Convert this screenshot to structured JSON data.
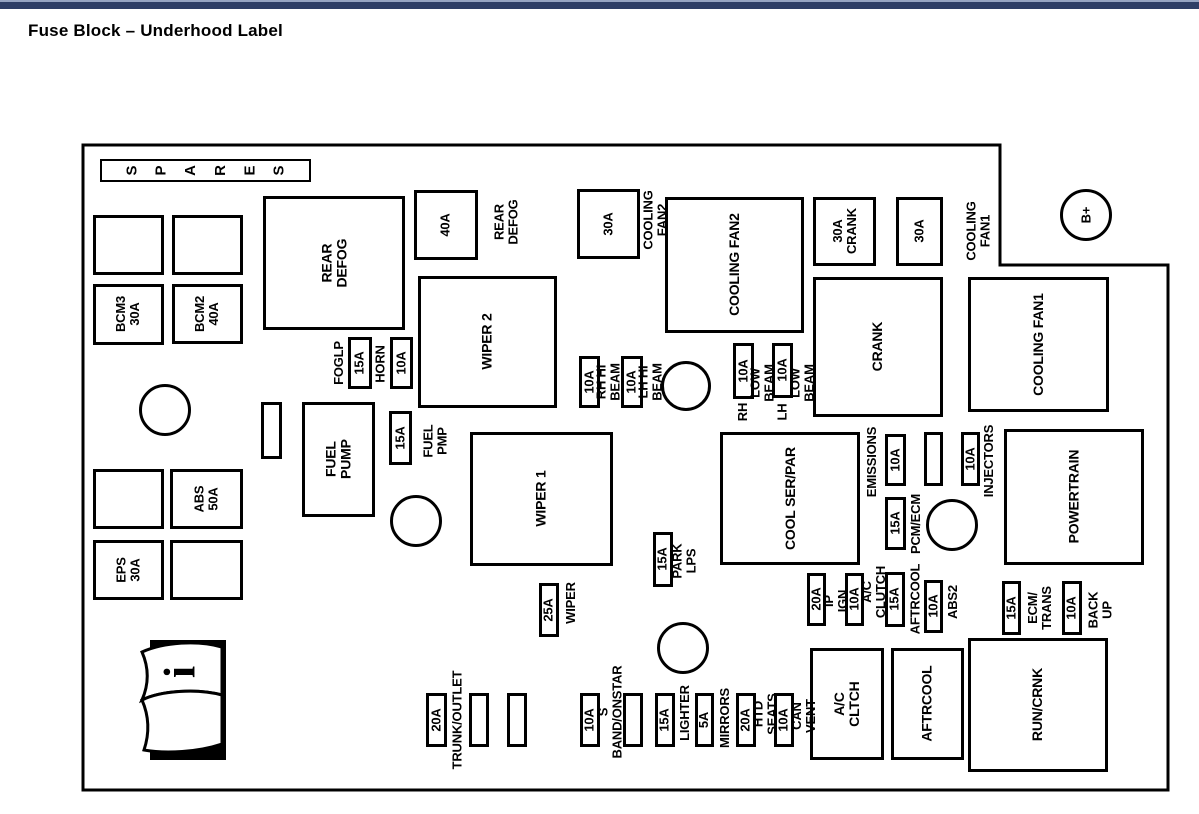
{
  "header": {
    "title": "Fuse Block – Underhood Label"
  },
  "colors": {
    "top_bar_dark": "#2e3e66",
    "top_bar_light": "#96a4c2",
    "line": "#000000",
    "background": "#ffffff"
  },
  "diagram": {
    "outline_points": "83,145 1000,145 1000,265 1168,265 1168,790 83,790",
    "spares": {
      "label": "SPARES",
      "x": 100,
      "y": 159,
      "w": 211,
      "h": 23
    },
    "info_icon": {
      "glyph": "i",
      "x": 136,
      "y": 638,
      "w": 92,
      "h": 124
    },
    "relays": [
      {
        "id": "rear-defog",
        "label": "REAR\nDEFOG",
        "x": 263,
        "y": 196,
        "w": 142,
        "h": 134
      },
      {
        "id": "wiper-2",
        "label": "WIPER 2",
        "x": 418,
        "y": 276,
        "w": 139,
        "h": 132
      },
      {
        "id": "fuel-pump",
        "label": "FUEL\nPUMP",
        "x": 302,
        "y": 402,
        "w": 73,
        "h": 115
      },
      {
        "id": "cooling-fan2",
        "label": "COOLING FAN2",
        "x": 665,
        "y": 197,
        "w": 139,
        "h": 136
      },
      {
        "id": "crank",
        "label": "CRANK",
        "x": 813,
        "y": 277,
        "w": 130,
        "h": 140
      },
      {
        "id": "cooling-fan1",
        "label": "COOLING FAN1",
        "x": 968,
        "y": 277,
        "w": 141,
        "h": 135
      },
      {
        "id": "wiper-1",
        "label": "WIPER 1",
        "x": 470,
        "y": 432,
        "w": 143,
        "h": 134
      },
      {
        "id": "cool-ser-par",
        "label": "COOL SER/PAR",
        "x": 720,
        "y": 432,
        "w": 140,
        "h": 133
      },
      {
        "id": "powertrain",
        "label": "POWERTRAIN",
        "x": 1004,
        "y": 429,
        "w": 140,
        "h": 136
      },
      {
        "id": "ac-cltch",
        "label": "A/C CLTCH",
        "x": 810,
        "y": 648,
        "w": 74,
        "h": 112
      },
      {
        "id": "aftrcool",
        "label": "AFTRCOOL",
        "x": 891,
        "y": 648,
        "w": 73,
        "h": 112
      },
      {
        "id": "run-crnk",
        "label": "RUN/CRNK",
        "x": 968,
        "y": 638,
        "w": 140,
        "h": 134
      }
    ],
    "fuses": [
      {
        "id": "bcm3-30a",
        "label": "BCM3\n30A",
        "x": 93,
        "y": 284,
        "w": 71,
        "h": 61
      },
      {
        "id": "bcm2-40a",
        "label": "BCM2\n40A",
        "x": 172,
        "y": 284,
        "w": 71,
        "h": 60
      },
      {
        "id": "abs-50a",
        "label": "ABS\n50A",
        "x": 170,
        "y": 469,
        "w": 73,
        "h": 60
      },
      {
        "id": "eps-30a",
        "label": "EPS\n30A",
        "x": 93,
        "y": 540,
        "w": 71,
        "h": 60
      },
      {
        "id": "foglp-15a",
        "label": "15A",
        "x": 348,
        "y": 337,
        "w": 24,
        "h": 52
      },
      {
        "id": "horn-10a",
        "label": "10A",
        "x": 390,
        "y": 337,
        "w": 23,
        "h": 52
      },
      {
        "id": "fuel-pmp-15a",
        "label": "15A",
        "x": 389,
        "y": 411,
        "w": 23,
        "h": 54
      },
      {
        "id": "rear-defog-40a",
        "label": "40A",
        "x": 414,
        "y": 190,
        "w": 64,
        "h": 70
      },
      {
        "id": "cooling-fan2-30a",
        "label": "30A",
        "x": 577,
        "y": 189,
        "w": 63,
        "h": 70
      },
      {
        "id": "rh-hi-beam-10a",
        "label": "10A",
        "x": 579,
        "y": 356,
        "w": 21,
        "h": 52
      },
      {
        "id": "lh-hi-beam-10a",
        "label": "10A",
        "x": 621,
        "y": 356,
        "w": 22,
        "h": 52
      },
      {
        "id": "rh-low-beam-10a",
        "label": "10A",
        "x": 733,
        "y": 343,
        "w": 21,
        "h": 56
      },
      {
        "id": "lh-low-beam-10a",
        "label": "10A",
        "x": 772,
        "y": 343,
        "w": 21,
        "h": 55
      },
      {
        "id": "crank-30a",
        "label": "30A\nCRANK",
        "x": 813,
        "y": 197,
        "w": 63,
        "h": 69
      },
      {
        "id": "cooling-fan1-30a",
        "label": "30A",
        "x": 896,
        "y": 197,
        "w": 47,
        "h": 69
      },
      {
        "id": "emissions-10a",
        "label": "10A",
        "x": 885,
        "y": 434,
        "w": 21,
        "h": 52
      },
      {
        "id": "pcm-ecm-15a",
        "label": "15A",
        "x": 885,
        "y": 497,
        "w": 21,
        "h": 53
      },
      {
        "id": "injectors-10a",
        "label": "10A",
        "x": 961,
        "y": 432,
        "w": 19,
        "h": 54
      },
      {
        "id": "wiper-25a",
        "label": "25A",
        "x": 539,
        "y": 583,
        "w": 20,
        "h": 54
      },
      {
        "id": "park-lps-15a",
        "label": "15A",
        "x": 653,
        "y": 532,
        "w": 20,
        "h": 55
      },
      {
        "id": "ip-ign-20a",
        "label": "20A",
        "x": 807,
        "y": 573,
        "w": 19,
        "h": 53
      },
      {
        "id": "ac-clutch-10a",
        "label": "10A",
        "x": 845,
        "y": 573,
        "w": 19,
        "h": 53
      },
      {
        "id": "aftrcool-15a",
        "label": "15A",
        "x": 885,
        "y": 572,
        "w": 20,
        "h": 55
      },
      {
        "id": "abs2-10a",
        "label": "10A",
        "x": 924,
        "y": 580,
        "w": 19,
        "h": 53
      },
      {
        "id": "ecm-trans-15a",
        "label": "15A",
        "x": 1002,
        "y": 581,
        "w": 19,
        "h": 54
      },
      {
        "id": "back-up-10a",
        "label": "10A",
        "x": 1062,
        "y": 581,
        "w": 20,
        "h": 54
      },
      {
        "id": "trunk-outlet-20a",
        "label": "20A",
        "x": 426,
        "y": 693,
        "w": 21,
        "h": 54
      },
      {
        "id": "s-band-10a",
        "label": "10A",
        "x": 580,
        "y": 693,
        "w": 20,
        "h": 54
      },
      {
        "id": "lighter-15a",
        "label": "15A",
        "x": 655,
        "y": 693,
        "w": 20,
        "h": 54
      },
      {
        "id": "mirrors-5a",
        "label": "5A",
        "x": 695,
        "y": 693,
        "w": 19,
        "h": 54
      },
      {
        "id": "htd-seats-20a",
        "label": "20A",
        "x": 736,
        "y": 693,
        "w": 20,
        "h": 54
      },
      {
        "id": "can-vent-10a",
        "label": "10A",
        "x": 774,
        "y": 693,
        "w": 20,
        "h": 54
      }
    ],
    "slots": [
      {
        "x": 93,
        "y": 215,
        "w": 71,
        "h": 60
      },
      {
        "x": 172,
        "y": 215,
        "w": 71,
        "h": 60
      },
      {
        "x": 93,
        "y": 469,
        "w": 71,
        "h": 60
      },
      {
        "x": 170,
        "y": 540,
        "w": 73,
        "h": 60
      },
      {
        "x": 261,
        "y": 402,
        "w": 21,
        "h": 57
      },
      {
        "x": 924,
        "y": 432,
        "w": 19,
        "h": 54
      },
      {
        "x": 469,
        "y": 693,
        "w": 20,
        "h": 54
      },
      {
        "x": 507,
        "y": 693,
        "w": 20,
        "h": 54
      },
      {
        "x": 623,
        "y": 693,
        "w": 20,
        "h": 54
      }
    ],
    "labels": [
      {
        "id": "foglp",
        "text": "FOGLP",
        "x": 330,
        "y": 336,
        "w": 17,
        "h": 54
      },
      {
        "id": "horn",
        "text": "HORN",
        "x": 372,
        "y": 338,
        "w": 17,
        "h": 52
      },
      {
        "id": "fuel-pmp",
        "text": "FUEL\nPMP",
        "x": 414,
        "y": 407,
        "w": 44,
        "h": 68
      },
      {
        "id": "rear-defog",
        "text": "REAR\nDEFOG",
        "x": 484,
        "y": 190,
        "w": 46,
        "h": 64
      },
      {
        "id": "cooling-fan2",
        "text": "COOLING FAN2",
        "x": 646,
        "y": 160,
        "w": 20,
        "h": 120
      },
      {
        "id": "rh-hi-beam",
        "text": "RH HI BEAM",
        "x": 600,
        "y": 332,
        "w": 17,
        "h": 100
      },
      {
        "id": "lh-hi-beam",
        "text": "LH HI BEAM",
        "x": 642,
        "y": 332,
        "w": 17,
        "h": 100
      },
      {
        "id": "rh",
        "text": "RH",
        "x": 733,
        "y": 398,
        "w": 21,
        "h": 28
      },
      {
        "id": "low-beam-rh",
        "text": "LOW BEAM",
        "x": 755,
        "y": 336,
        "w": 16,
        "h": 94
      },
      {
        "id": "lh",
        "text": "LH",
        "x": 772,
        "y": 398,
        "w": 21,
        "h": 28
      },
      {
        "id": "low-beam-lh",
        "text": "LOW BEAM",
        "x": 795,
        "y": 336,
        "w": 16,
        "h": 94
      },
      {
        "id": "cooling-fan1",
        "text": "COOLING\nFAN1",
        "x": 958,
        "y": 194,
        "w": 42,
        "h": 74
      },
      {
        "id": "emissions",
        "text": "EMISSIONS",
        "x": 864,
        "y": 416,
        "w": 17,
        "h": 92
      },
      {
        "id": "pcm-ecm",
        "text": "PCM/ECM",
        "x": 907,
        "y": 478,
        "w": 17,
        "h": 92
      },
      {
        "id": "injectors",
        "text": "INJECTORS",
        "x": 981,
        "y": 414,
        "w": 17,
        "h": 94
      },
      {
        "id": "wiper",
        "text": "WIPER",
        "x": 562,
        "y": 570,
        "w": 18,
        "h": 66
      },
      {
        "id": "park-lps",
        "text": "PARK LPS",
        "x": 676,
        "y": 523,
        "w": 18,
        "h": 76
      },
      {
        "id": "ip-ign",
        "text": "IP IGN",
        "x": 828,
        "y": 570,
        "w": 16,
        "h": 62
      },
      {
        "id": "ac-clutch",
        "text": "A/C CLUTCH",
        "x": 866,
        "y": 549,
        "w": 16,
        "h": 86
      },
      {
        "id": "aftrcool",
        "text": "AFTRCOOL",
        "x": 907,
        "y": 556,
        "w": 16,
        "h": 86
      },
      {
        "id": "abs2",
        "text": "ABS2",
        "x": 945,
        "y": 577,
        "w": 16,
        "h": 50
      },
      {
        "id": "ecm-trans",
        "text": "ECM/\nTRANS",
        "x": 1023,
        "y": 575,
        "w": 34,
        "h": 66
      },
      {
        "id": "back-up",
        "text": "BACK\nUP",
        "x": 1084,
        "y": 577,
        "w": 32,
        "h": 66
      },
      {
        "id": "trunk-outlet",
        "text": "TRUNK/OUTLET",
        "x": 448,
        "y": 650,
        "w": 18,
        "h": 140
      },
      {
        "id": "s-band-onstar",
        "text": "S BAND/ONSTAR",
        "x": 601,
        "y": 648,
        "w": 18,
        "h": 128
      },
      {
        "id": "lighter",
        "text": "LIGHTER",
        "x": 677,
        "y": 668,
        "w": 16,
        "h": 90
      },
      {
        "id": "mirrors",
        "text": "MIRRORS",
        "x": 716,
        "y": 672,
        "w": 17,
        "h": 92
      },
      {
        "id": "htd-seats",
        "text": "HTD SEATS",
        "x": 757,
        "y": 668,
        "w": 17,
        "h": 92
      },
      {
        "id": "can-vent",
        "text": "CAN VENT",
        "x": 795,
        "y": 670,
        "w": 17,
        "h": 92
      }
    ],
    "circles": [
      {
        "id": "stud-1",
        "cx": 165,
        "cy": 410,
        "r": 26
      },
      {
        "id": "stud-2",
        "cx": 416,
        "cy": 521,
        "r": 26
      },
      {
        "id": "stud-3",
        "cx": 686,
        "cy": 386,
        "r": 25
      },
      {
        "id": "stud-4",
        "cx": 683,
        "cy": 648,
        "r": 26
      },
      {
        "id": "stud-5",
        "cx": 952,
        "cy": 525,
        "r": 26
      },
      {
        "id": "b-plus",
        "cx": 1086,
        "cy": 215,
        "r": 26,
        "label": "B+"
      }
    ]
  }
}
